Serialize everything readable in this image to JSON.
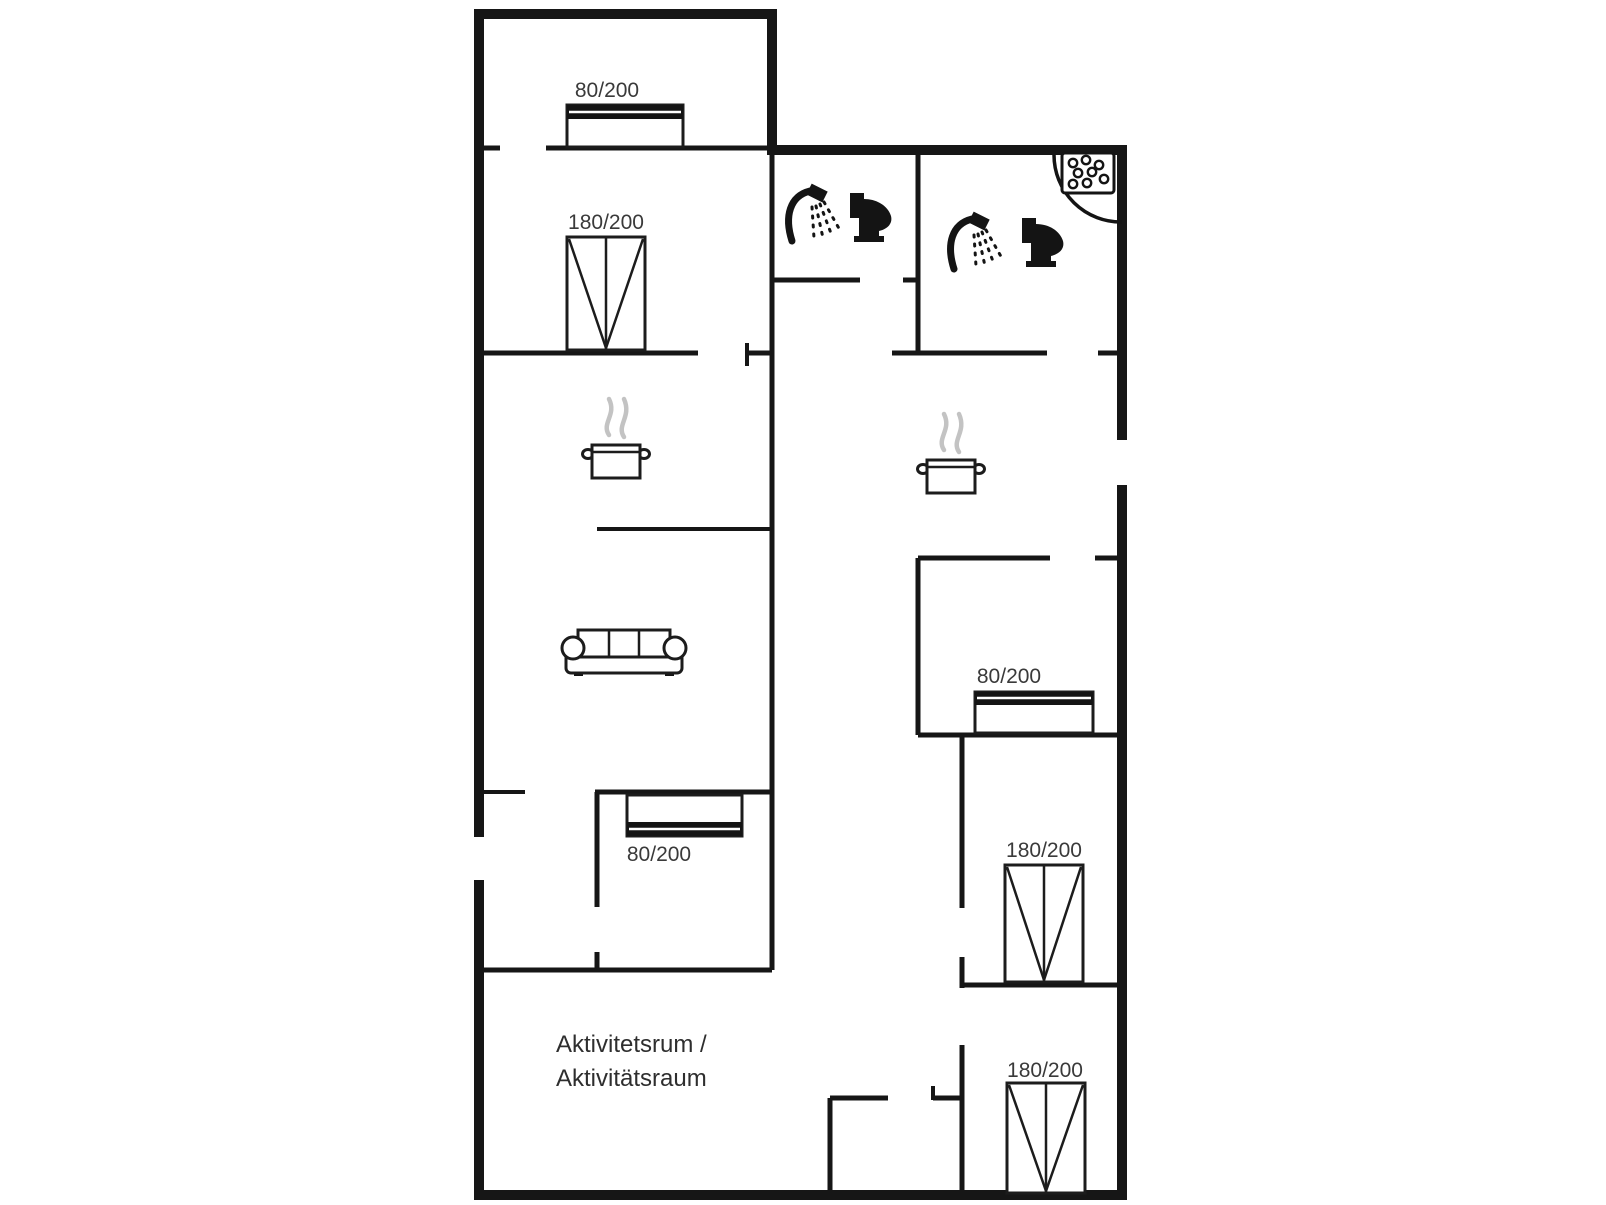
{
  "floor_plan": {
    "activity_room": {
      "line1": "Aktivitetsrum /",
      "line2": "Aktivitätsraum"
    },
    "beds": [
      {
        "id": "bed-top-single",
        "label": "80/200"
      },
      {
        "id": "bed-upper-double",
        "label": "180/200"
      },
      {
        "id": "bed-right-single",
        "label": "80/200"
      },
      {
        "id": "bed-nook-single",
        "label": "80/200"
      },
      {
        "id": "bed-mid-right-double",
        "label": "180/200"
      },
      {
        "id": "bed-bottom-right-double",
        "label": "180/200"
      }
    ],
    "icons": [
      {
        "name": "shower-icon"
      },
      {
        "name": "toilet-icon"
      },
      {
        "name": "spa-bath-icon"
      },
      {
        "name": "cooking-pot-icon"
      },
      {
        "name": "sofa-icon"
      }
    ],
    "colors": {
      "wall": "#161616",
      "furniture": "#1c1c1c",
      "label": "#3a3a3a",
      "steam": "#c3c3c3",
      "background": "#ffffff"
    }
  }
}
